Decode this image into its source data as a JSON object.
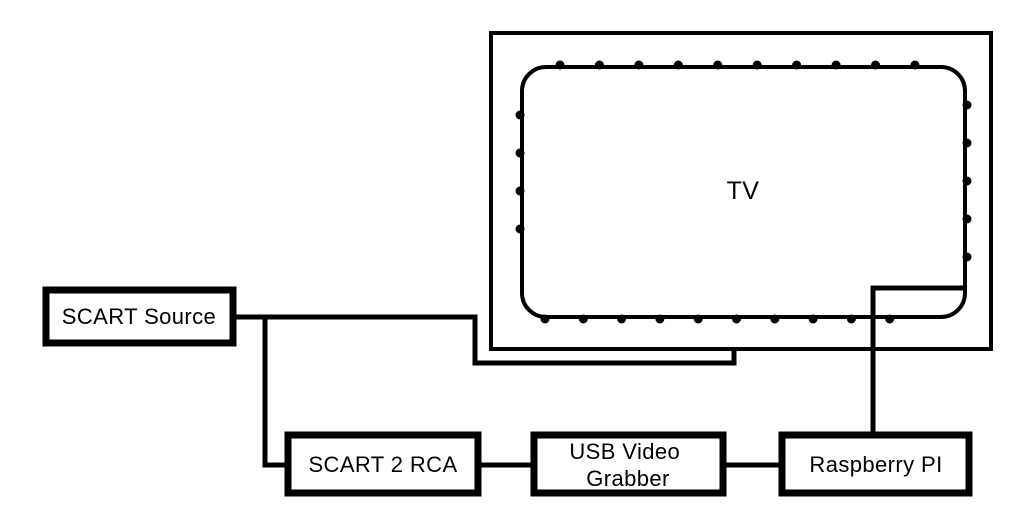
{
  "diagram": {
    "type": "wiring-diagram",
    "background_color": "#ffffff",
    "line_color": "#000000",
    "text_color": "#000000",
    "nodes": [
      {
        "id": "tv",
        "label": "TV"
      },
      {
        "id": "scart-source",
        "label": "SCART Source"
      },
      {
        "id": "scart-2-rca",
        "label": "SCART 2 RCA"
      },
      {
        "id": "usb-video-grabber",
        "label": "USB Video Grabber",
        "label_lines": [
          "USB Video",
          "Grabber"
        ]
      },
      {
        "id": "raspberry-pi",
        "label": "Raspberry PI"
      }
    ],
    "connections": [
      {
        "from": "SCART Source",
        "to": "TV"
      },
      {
        "from": "SCART Source",
        "to": "SCART 2 RCA"
      },
      {
        "from": "SCART 2 RCA",
        "to": "USB Video Grabber"
      },
      {
        "from": "USB Video Grabber",
        "to": "Raspberry PI"
      },
      {
        "from": "Raspberry PI",
        "to": "TV"
      }
    ]
  }
}
